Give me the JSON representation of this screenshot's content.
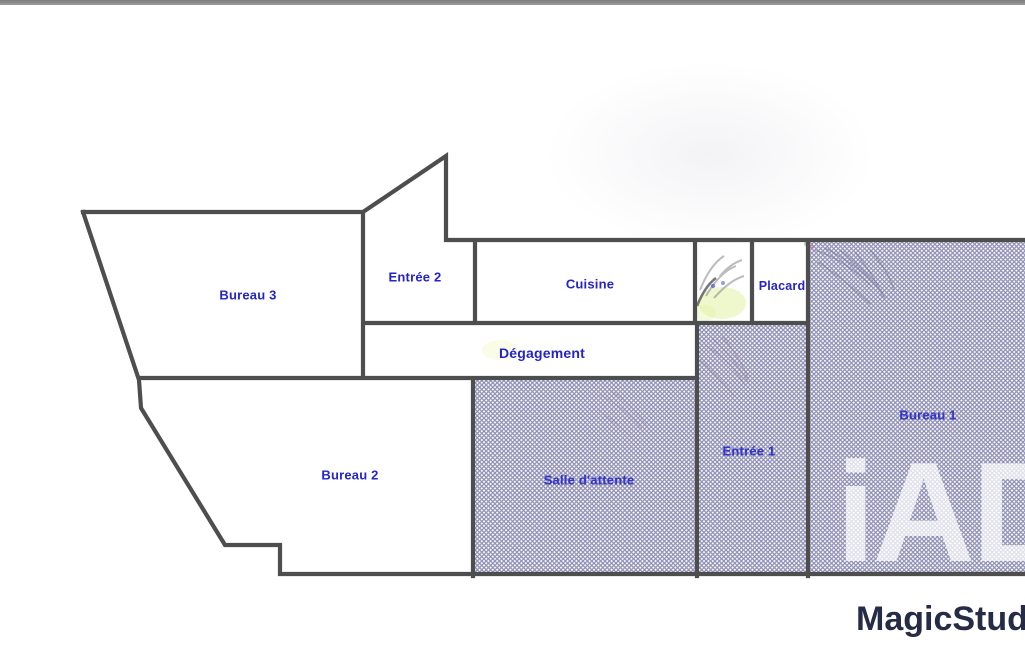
{
  "page": {
    "type": "floor-plan-photo",
    "background": "#ffffff",
    "top_bar_color": "#8c8c8c"
  },
  "floorplan": {
    "wall_color": "#4e4e4e",
    "label_color": "#2424c8",
    "hatch_line_color": "#8d8db2",
    "rooms": [
      {
        "id": "bureau-3",
        "label": "Bureau 3",
        "hatched": false
      },
      {
        "id": "entree-2",
        "label": "Entrée 2",
        "hatched": false
      },
      {
        "id": "cuisine",
        "label": "Cuisine",
        "hatched": false
      },
      {
        "id": "placard",
        "label": "Placard",
        "hatched": false
      },
      {
        "id": "degagement",
        "label": "Dégagement",
        "hatched": false
      },
      {
        "id": "bureau-2",
        "label": "Bureau 2",
        "hatched": false
      },
      {
        "id": "salle-attente",
        "label": "Salle d'attente",
        "hatched": true
      },
      {
        "id": "entree-1",
        "label": "Entrée 1",
        "hatched": true
      },
      {
        "id": "bureau-1",
        "label": "Bureau 1",
        "hatched": true
      }
    ]
  },
  "watermarks": {
    "brand_large": "iAD",
    "studio": "MagicStudio",
    "studio_color": "#262b46"
  }
}
